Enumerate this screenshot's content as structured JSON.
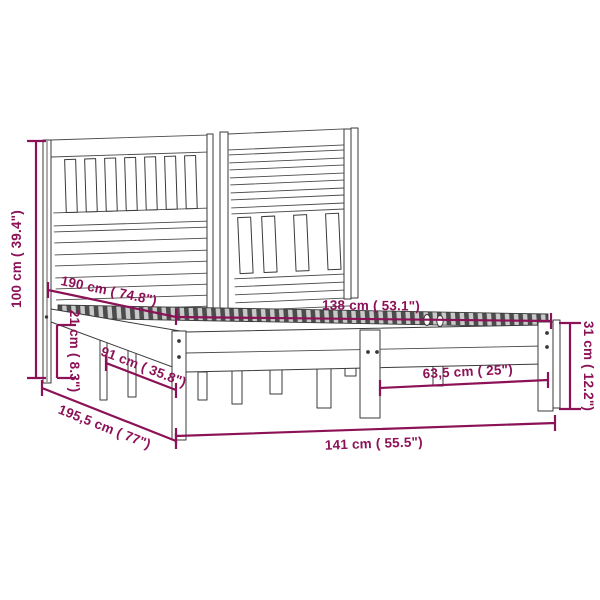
{
  "diagram": {
    "subject": "bed-frame-dimension-diagram",
    "colors": {
      "dimension_annotation": "#8C1257",
      "line_art": "#3A3A3A",
      "background": "#FFFFFF"
    },
    "dimensions": {
      "overall_height": {
        "label": "100 cm ( 39.4\")",
        "cm": "100",
        "inches": "39.4"
      },
      "inner_length": {
        "label": "190 cm ( 74.8\")",
        "cm": "190",
        "inches": "74.8"
      },
      "under_bed_clearance": {
        "label": "21 cm ( 8.3\")",
        "cm": "21",
        "inches": "8.3"
      },
      "side_leg_span": {
        "label": "91 cm ( 35.8\")",
        "cm": "91",
        "inches": "35.8"
      },
      "inner_width": {
        "label": "138 cm ( 53.1\")",
        "cm": "138",
        "inches": "53.1"
      },
      "foot_end_height": {
        "label": "31 cm ( 12.2\")",
        "cm": "31",
        "inches": "12.2"
      },
      "front_leg_span": {
        "label": "63,5 cm ( 25\")",
        "cm": "63,5",
        "inches": "25"
      },
      "overall_width": {
        "label": "141 cm ( 55.5\")",
        "cm": "141",
        "inches": "55.5"
      },
      "overall_length": {
        "label": "195,5 cm ( 77\")",
        "cm": "195,5",
        "inches": "77"
      }
    }
  }
}
